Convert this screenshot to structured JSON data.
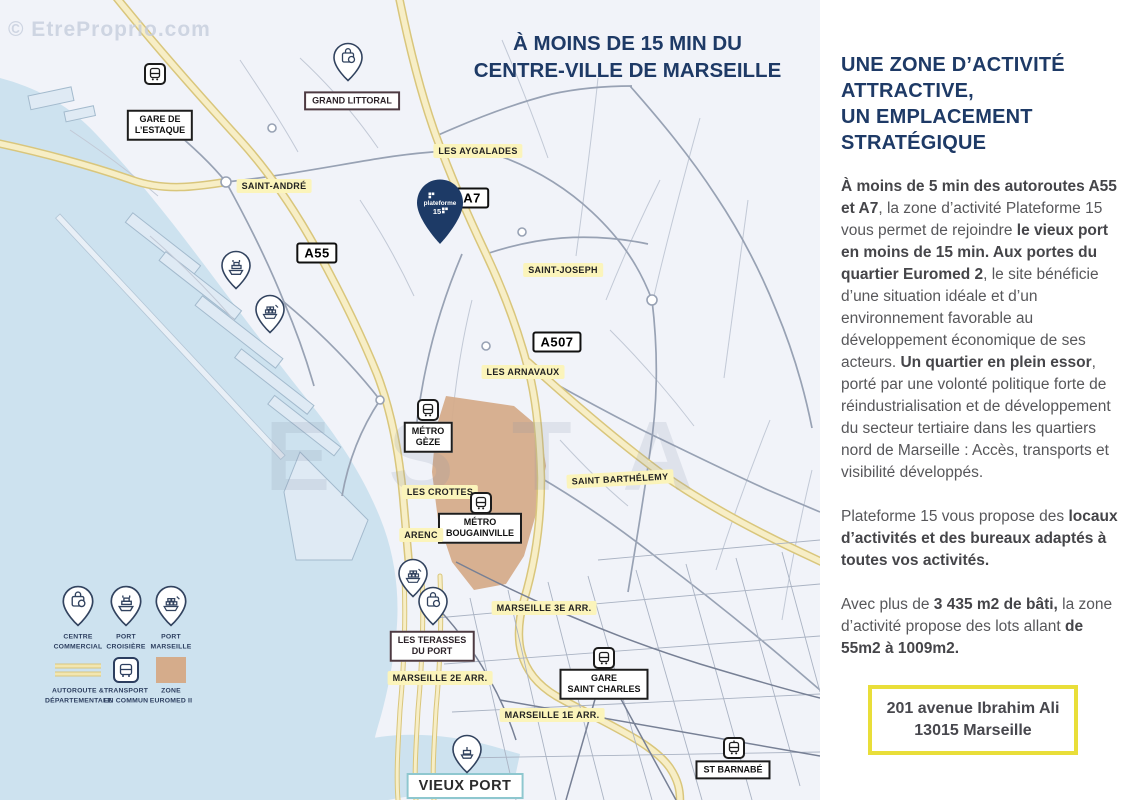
{
  "watermark_topleft": "© EtreProprio.com",
  "watermark_center": "ESTA",
  "map": {
    "title": "À MOINS DE 15 MIN DU\nCENTRE-VILLE DE MARSEILLE",
    "plateforme_pin": "plateforme",
    "plateforme_pin_number": "15",
    "labels": {
      "gare_estaque": "GARE DE\nL’ESTAQUE",
      "grand_littoral": "GRAND LITTORAL",
      "saint_andre": "SAINT-ANDRÉ",
      "les_aygalades": "LES AYGALADES",
      "a7": "A7",
      "a55": "A55",
      "a507": "A507",
      "saint_joseph": "SAINT-JOSEPH",
      "les_arnavaux": "LES ARNAVAUX",
      "metro_geze": "MÉTRO\nGÈZE",
      "saint_barthelemy": "SAINT BARTHÉLEMY",
      "les_crottes": "LES CROTTES",
      "metro_bougainville": "MÉTRO\nBOUGAINVILLE",
      "arenc": "ARENC",
      "marseille_3e": "MARSEILLE 3E ARR.",
      "les_terasses": "LES TERASSES\nDU PORT",
      "marseille_2e": "MARSEILLE 2E ARR.",
      "gare_saint_charles": "GARE\nSAINT CHARLES",
      "marseille_1e": "MARSEILLE 1E ARR.",
      "st_barnabe": "ST BARNABÉ",
      "vieux_port": "VIEUX PORT"
    },
    "legend": {
      "centre_commercial": "CENTRE\nCOMMERCIAL",
      "port_croisiere": "PORT\nCROISIÈRE",
      "port_marseille": "PORT\nMARSEILLE",
      "autoroute": "AUTOROUTE &\nDÉPARTEMENTALE",
      "transport": "TRANSPORT\nEN COMMUN",
      "zone_euromed": "ZONE\nEUROMED II"
    }
  },
  "panel": {
    "heading": "UNE ZONE D’ACTIVITÉ\nATTRACTIVE,\nUN EMPLACEMENT\nSTRATÉGIQUE",
    "p1": [
      "À moins de 5 min des autoroutes A55 et A7",
      ", la zone d’activité Plateforme 15 vous permet de rejoindre ",
      "le vieux port en moins de 15 min. Aux portes du quartier Euromed 2",
      ", le site bénéficie d’une situation idéale et d’un environnement favorable au développement économique de ses acteurs. ",
      "Un quartier en plein essor",
      ", porté par une volonté politique forte de réindustrialisation et de développement du secteur tertiaire dans les quartiers nord de Marseille : Accès, transports et visibilité développés."
    ],
    "p2": [
      "Plateforme 15 vous propose des ",
      "locaux d’activités et des bureaux adaptés à toutes vos activités."
    ],
    "p3": [
      "Avec plus de ",
      "3 435 m2 de bâti,",
      " la zone d’activité propose des lots allant ",
      "de 55m2 à 1009m2."
    ],
    "address": "201 avenue Ibrahim Ali\n13015 Marseille"
  },
  "colors": {
    "navy": "#1e3a66",
    "sea": "#cde2ef",
    "zone_tan": "#d5ac8b",
    "road_yellow": "#f7eec6",
    "road_yellow_edge": "#d9c67c",
    "address_border": "#e9de39"
  }
}
